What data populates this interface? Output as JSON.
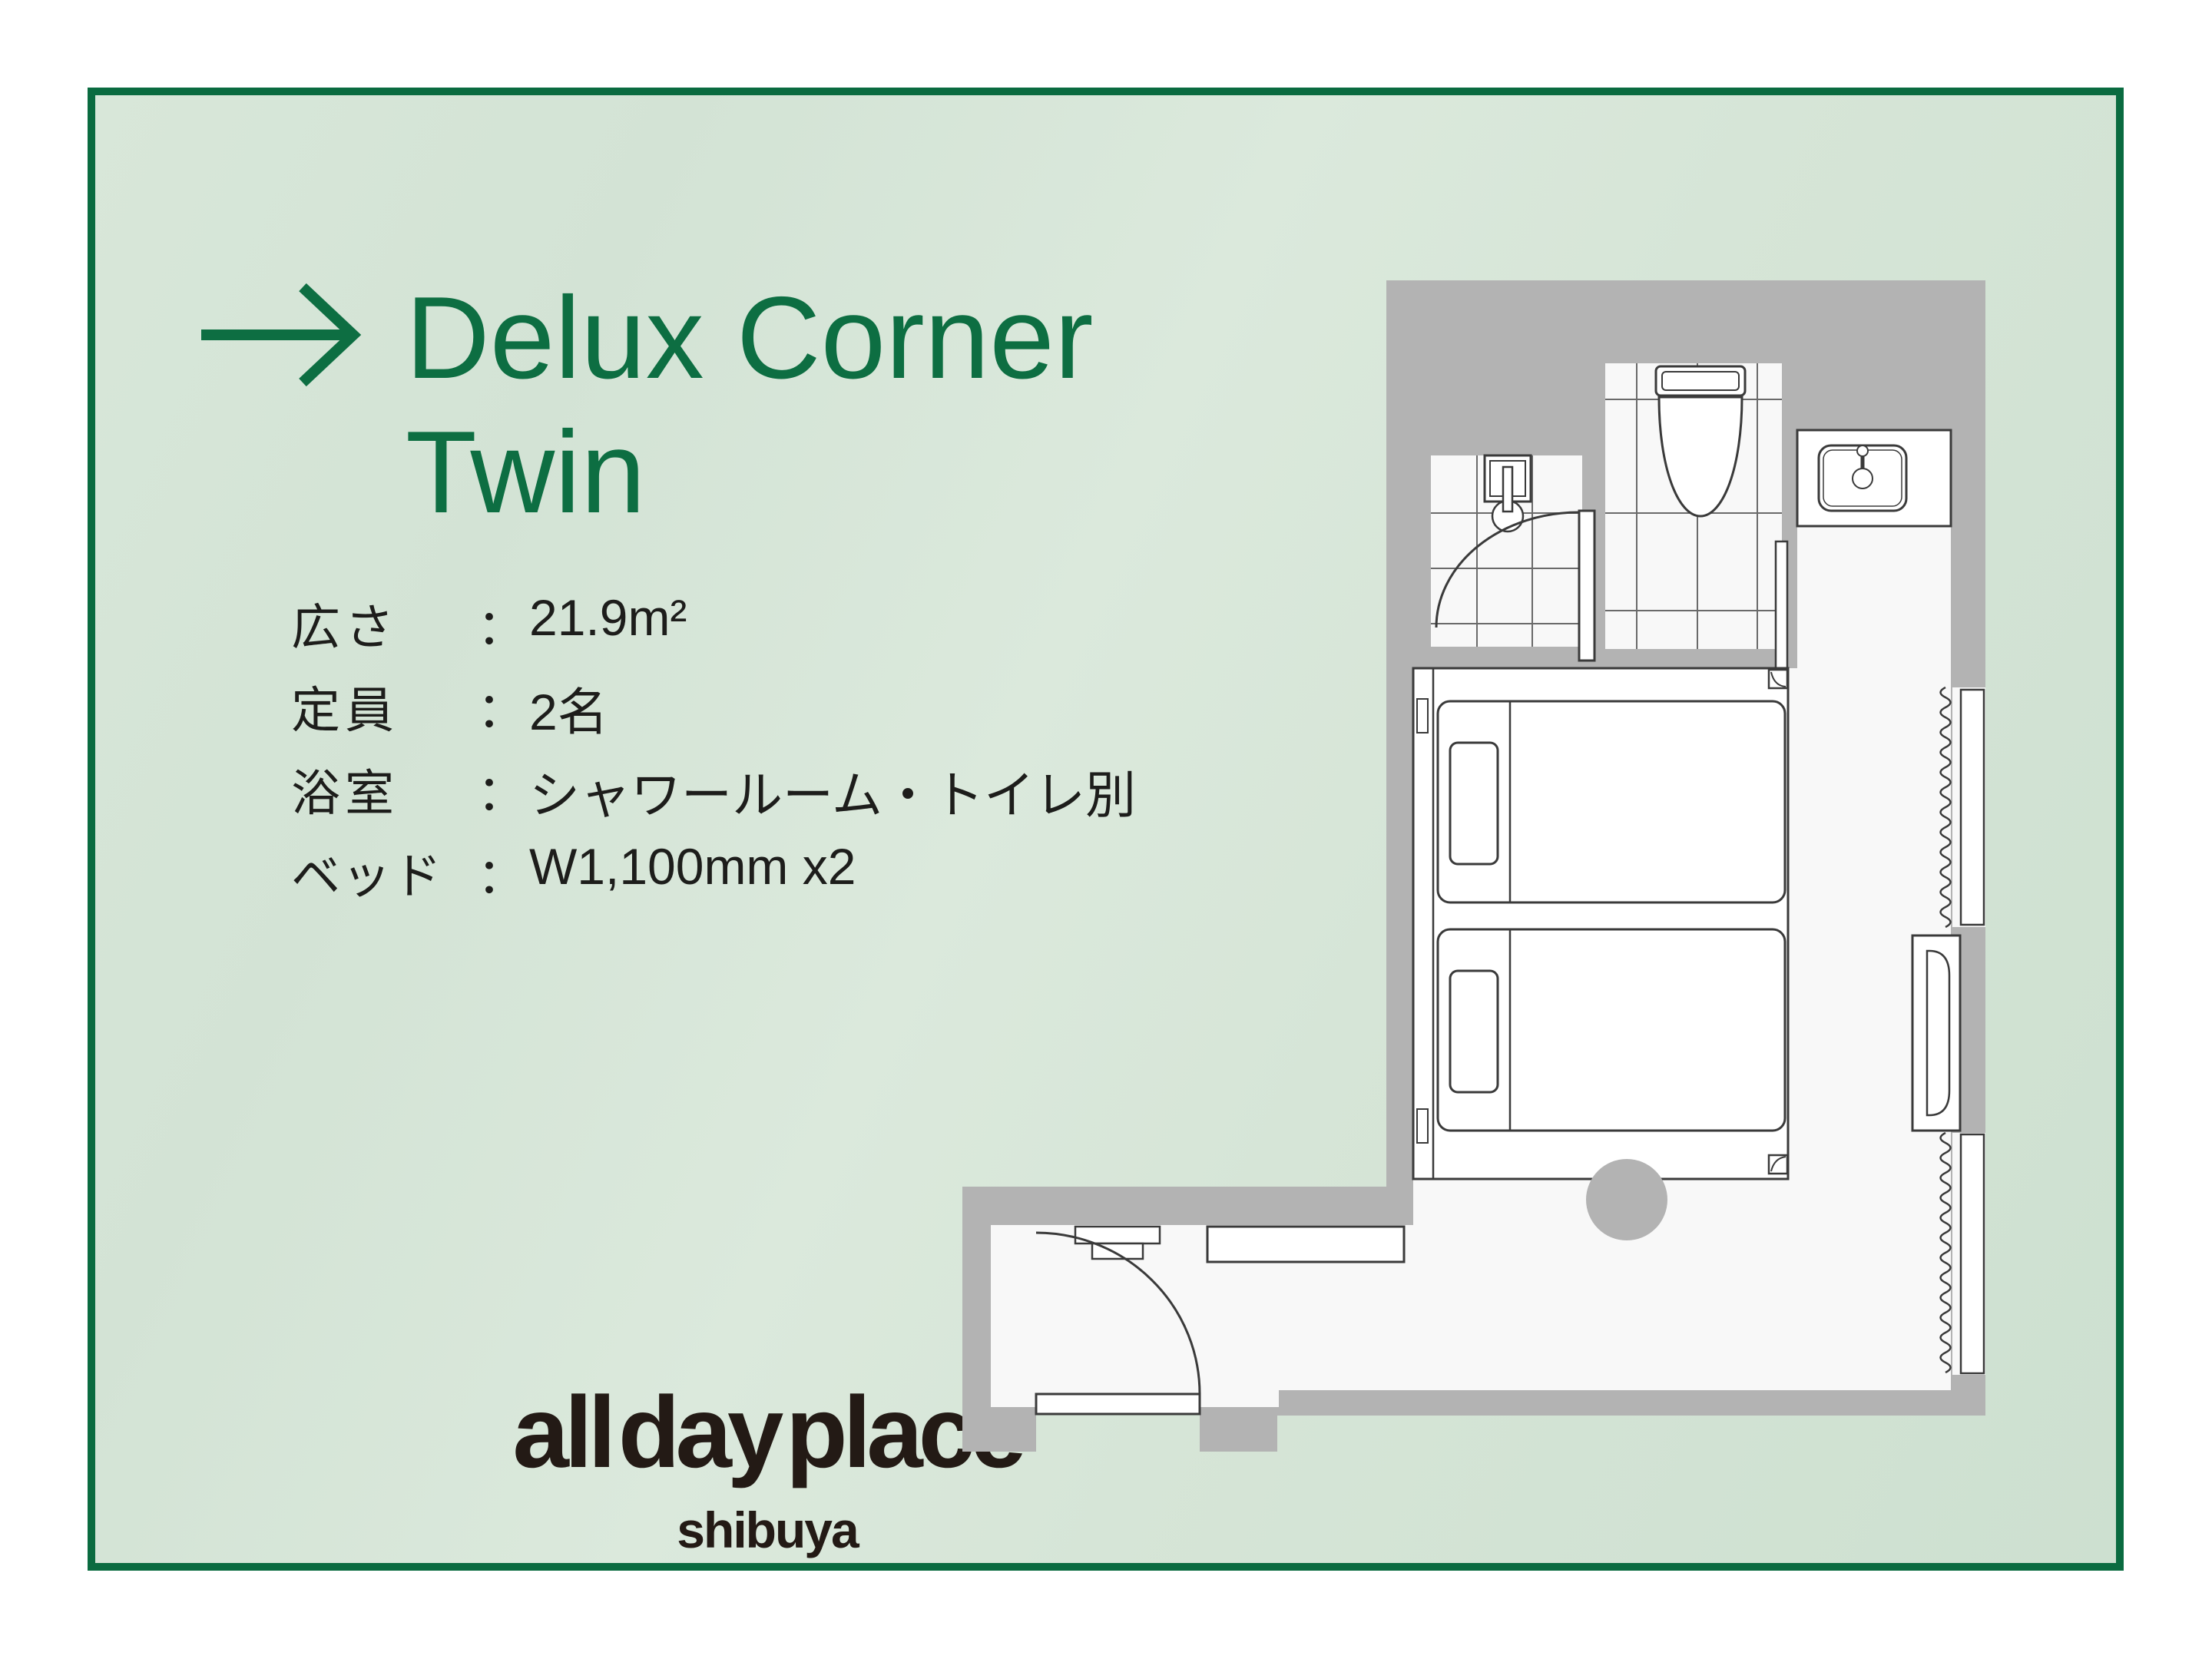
{
  "card": {
    "border_color": "#0a6b40",
    "bg_color": "#d6e5d7",
    "title_color": "#0d6e42",
    "title_line1": "Delux Corner",
    "title_line2": "Twin"
  },
  "specs": {
    "colon": "：",
    "rows": [
      {
        "label": "広さ",
        "value": "21.9m²"
      },
      {
        "label": "定員",
        "value": "2名"
      },
      {
        "label": "浴室",
        "value": "シャワールーム・トイレ別"
      },
      {
        "label": "ベッド",
        "value": "W1,100mm x2"
      }
    ]
  },
  "logo": {
    "name": "all day place",
    "sub": "shibuya",
    "color": "#231a15"
  },
  "floorplan": {
    "wall_color": "#b3b3b3",
    "floor_color": "#f8f8f8",
    "line_color": "#3a3a3a",
    "elements": [
      "entrance-door",
      "corridor-shelf",
      "entry-fixture",
      "twin-bed-1",
      "twin-bed-2",
      "round-table",
      "shower-room",
      "shower-door",
      "toilet",
      "toilet-sliding-door",
      "sink-counter",
      "window-1",
      "window-2",
      "wall-mirror-cabinet"
    ]
  }
}
